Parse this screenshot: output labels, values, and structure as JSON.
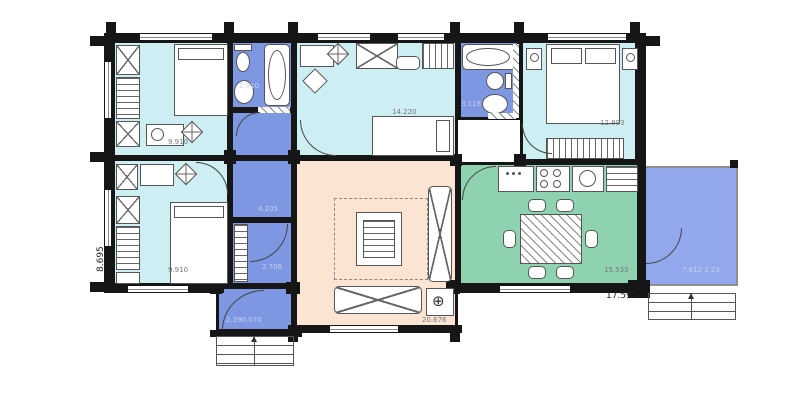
{
  "plan_type": "floor-plan",
  "rooms": {
    "bedroom_top_left": {
      "area": "9.910"
    },
    "bathroom_1": {
      "area": "2.910"
    },
    "bedroom_top_middle": {
      "area": "14.220"
    },
    "bathroom_2": {
      "area": "3.118"
    },
    "bedroom_top_right": {
      "area": "12.993"
    },
    "corridor": {
      "area": "4.205"
    },
    "hall": {
      "area": "2.706"
    },
    "bedroom_bottom_left": {
      "area": "9.910"
    },
    "entry": {
      "area": "2.390.070"
    },
    "living_room": {
      "area": "20.676"
    },
    "kitchen_dining": {
      "area": "15.533"
    },
    "terrace": {
      "area": "7.612 2.23"
    }
  },
  "dimensions": {
    "overall_width": "17.595",
    "overall_height": "8.695"
  },
  "icons": {
    "fireplace": "⊕"
  },
  "colors": {
    "wall": "#161616",
    "bedroom_fill": "#cdeef3",
    "wet_room_fill": "#7e97e3",
    "terrace_fill": "#93a7ec",
    "living_fill": "#fbe4d2",
    "dining_fill": "#8ed2b0"
  }
}
